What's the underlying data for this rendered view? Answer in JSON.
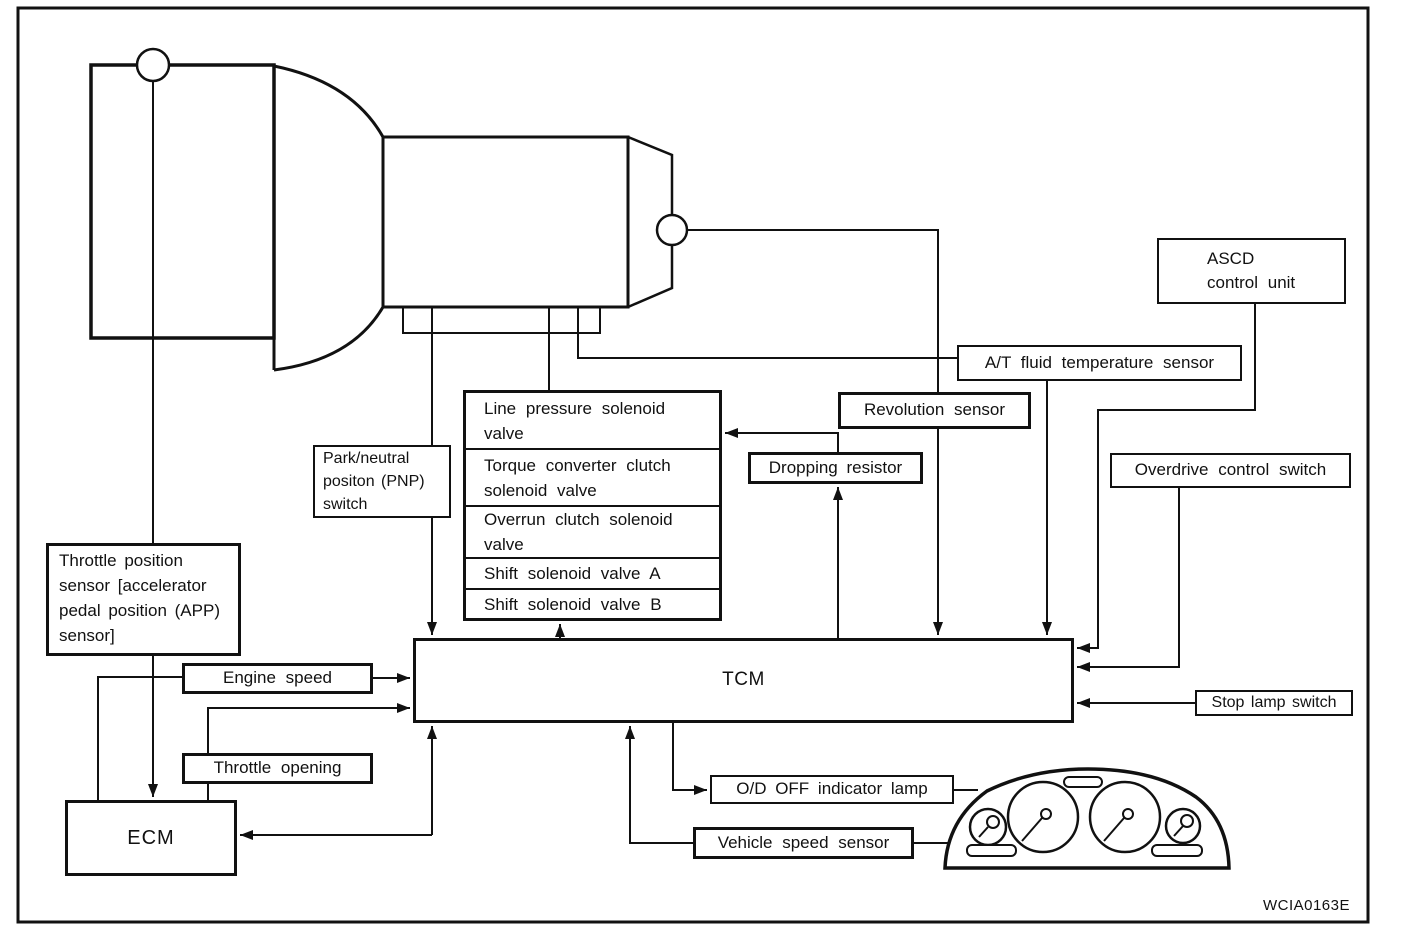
{
  "diagram": {
    "watermark": "WCIA0163E",
    "colors": {
      "ink": "#111111",
      "background": "#ffffff"
    },
    "boxes": {
      "throttle_position_sensor": "Throttle position sensor [accelerator pedal position (APP) sensor]",
      "engine_speed": "Engine speed",
      "throttle_opening": "Throttle opening",
      "ecm": "ECM",
      "tcm": "TCM",
      "pnp_switch": "Park/neutral positon (PNP) switch",
      "dropping_resistor": "Dropping resistor",
      "revolution_sensor": "Revolution sensor",
      "at_fluid_temp_sensor": "A/T fluid temperature sensor",
      "ascd_line1": "ASCD",
      "ascd_line2": "control unit",
      "overdrive_control_switch": "Overdrive control switch",
      "stop_lamp_switch": "Stop lamp switch",
      "od_off_indicator_lamp": "O/D OFF indicator lamp",
      "vehicle_speed_sensor": "Vehicle speed sensor"
    },
    "solenoid_valves": [
      "Line pressure solenoid valve",
      "Torque converter clutch solenoid valve",
      "Overrun clutch solenoid valve",
      "Shift solenoid valve A",
      "Shift solenoid valve B"
    ]
  }
}
